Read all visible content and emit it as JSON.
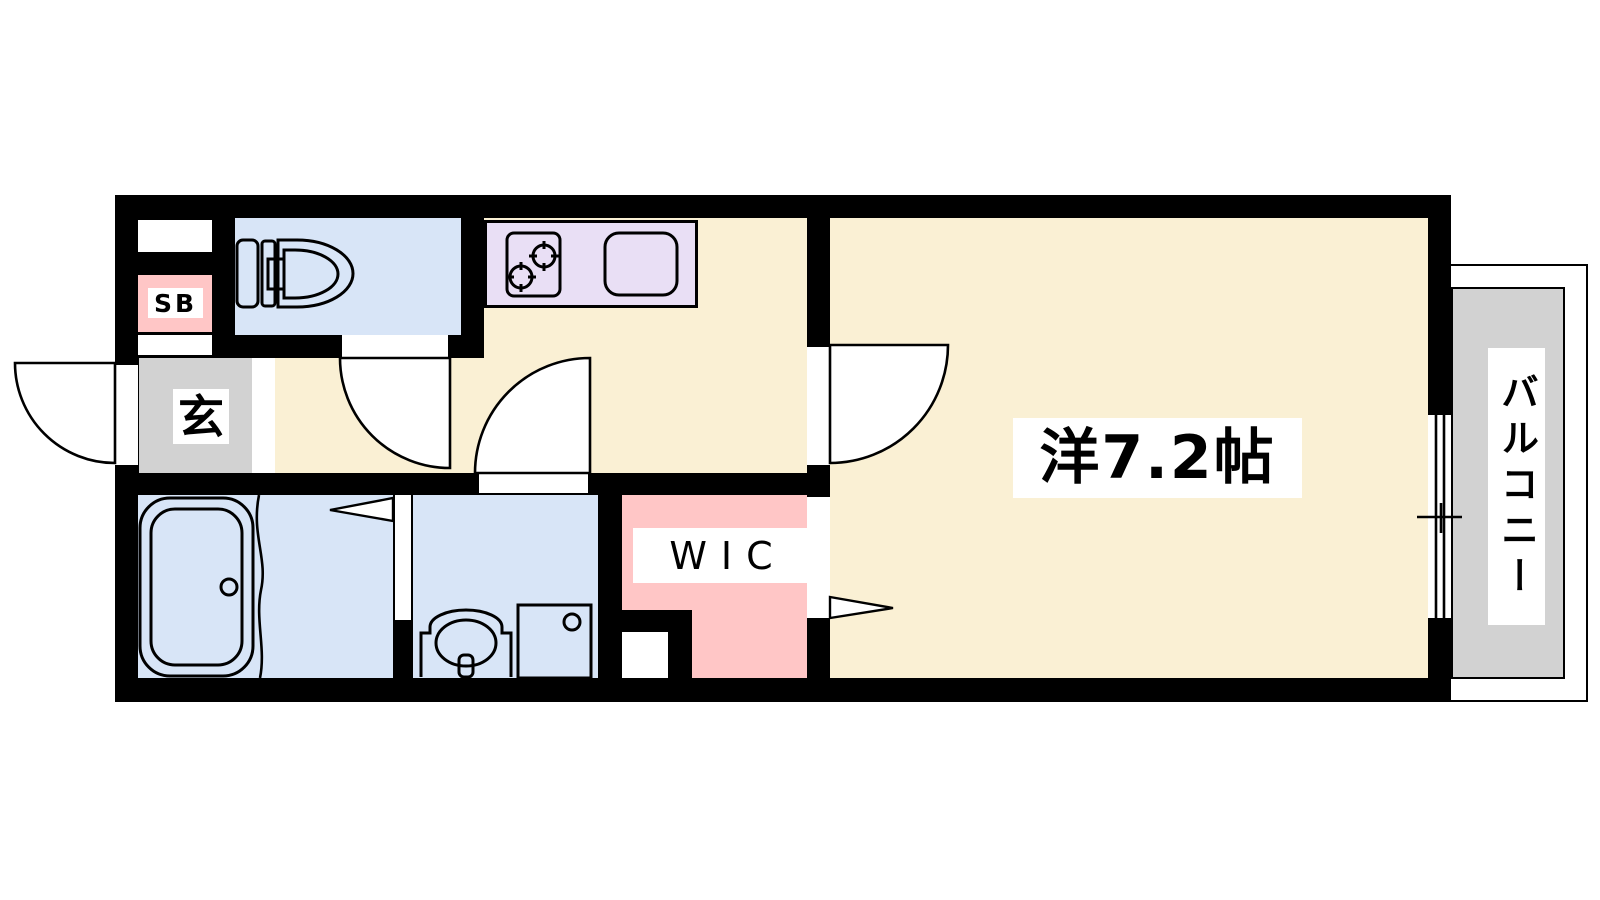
{
  "labels": {
    "main_room": "洋7.2帖",
    "wic": "WIC",
    "entrance": "玄",
    "shoe_box": "SB",
    "balcony": "バルコニー"
  },
  "colors": {
    "wall": "#000000",
    "floor_cream": "#FAF0D4",
    "water_blue": "#D8E5F7",
    "kitchen_lavender": "#E9DFF5",
    "closet_pink": "#FFC6C6",
    "entrance_gray": "#D2D2D2",
    "balcony_gray": "#D2D2D2"
  },
  "fixtures": {
    "toilet": "toilet-icon",
    "stove": "gas-stove-icon",
    "kitchen_sink": "kitchen-sink-icon",
    "bathtub": "bathtub-icon",
    "washbasin": "washbasin-icon",
    "washer_pan": "washing-machine-pan-icon",
    "window": "sliding-window-icon",
    "doors": [
      "entrance-door",
      "toilet-door",
      "lavatory-door",
      "main-room-door",
      "wic-door",
      "bathroom-folding-door"
    ]
  }
}
